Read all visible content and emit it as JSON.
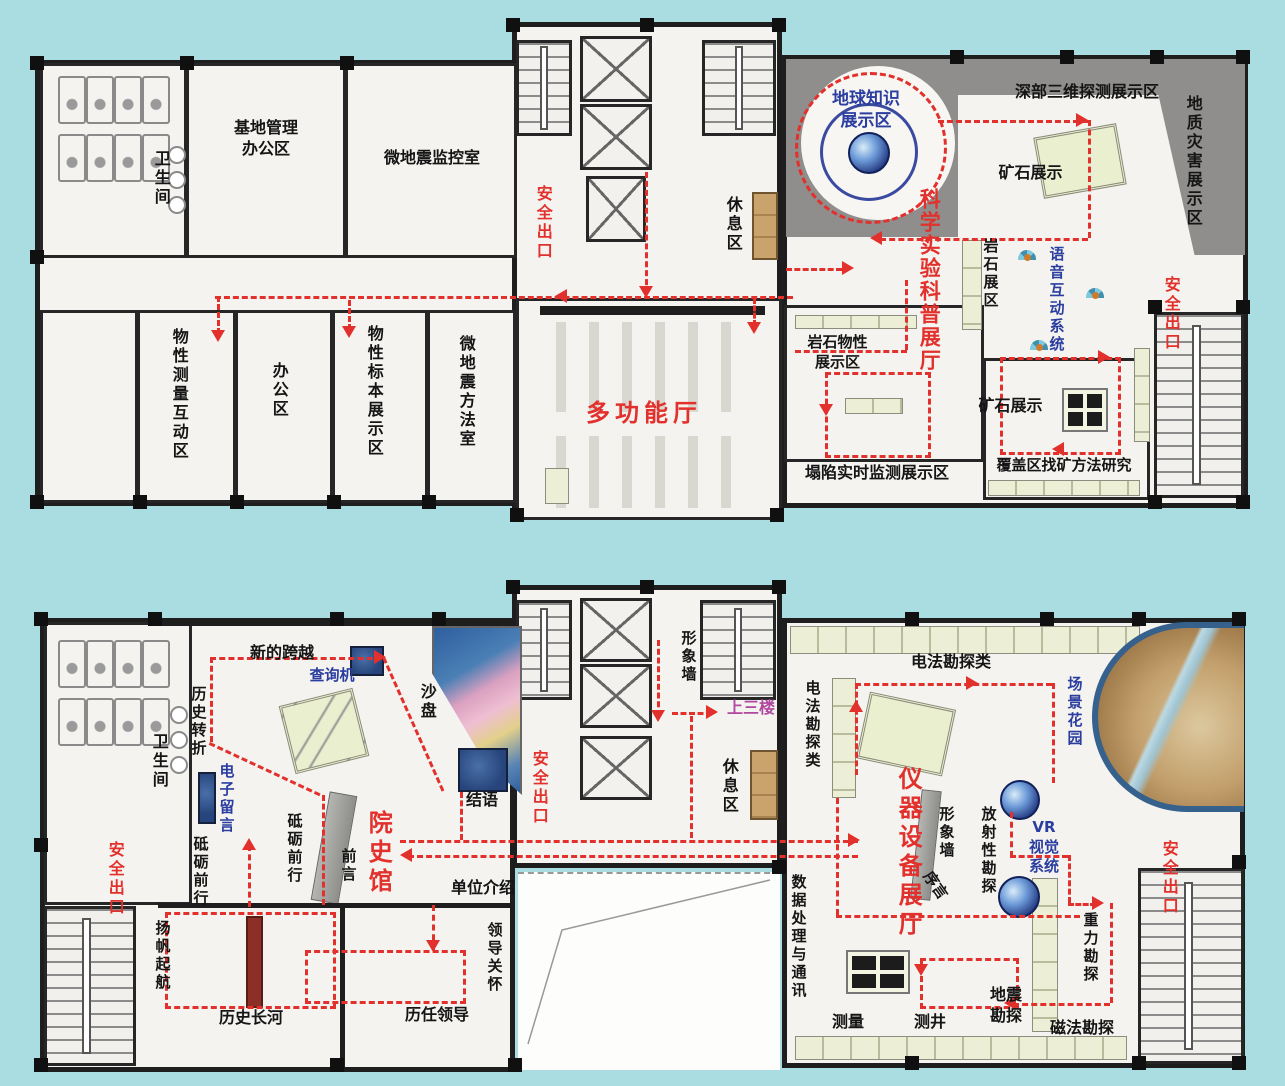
{
  "common": {
    "safety_exit": "安全出口",
    "restroom": "卫生间",
    "rest_area": "休息区",
    "ore_display": "矿石展示"
  },
  "plan_top": {
    "labels": {
      "base_office": "基地管理\n办公区",
      "micro_monitor": "微地震监控室",
      "prop_measure": "物性测量互动区",
      "office": "办公区",
      "prop_specimen": "物性标本展示区",
      "micro_method": "微地震方法室",
      "multi_hall": "多功能厅",
      "sci_hall": "科学实验科普展厅",
      "earth_knowledge": "地球知识\n展示区",
      "deep_3d": "深部三维探测展示区",
      "geo_disaster": "地质灾害展示区",
      "rock_zone": "岩石展区",
      "voice_system": "语音互动系统",
      "rock_physical": "岩石物性\n展示区",
      "collapse_monitor": "塌陷实时监测展示区",
      "covered_method": "覆盖区找矿方法研究"
    }
  },
  "plan_bottom": {
    "labels": {
      "history_hall": "院史馆",
      "new_leap": "新的跨越",
      "query_machine": "查询机",
      "sand_table": "沙盘",
      "history_turn": "历史转折",
      "e_message": "电子留言",
      "forge_ahead": "砥砺前行",
      "conclusion": "结语",
      "foreword": "前言",
      "preface": "序言",
      "sail": "扬帆起航",
      "history_river": "历史长河",
      "past_leaders": "历任领导",
      "unit_intro": "单位介绍",
      "leader_care": "领导关怀",
      "image_wall": "形象墙",
      "up_third": "上三楼",
      "instrument_hall": "仪器设备展厅",
      "electrical": "电法勘探类",
      "scene_garden": "场景花园",
      "vr_system": "VR\n视觉\n系统",
      "radioactive": "放射性勘探",
      "data_comm": "数据处理与通讯",
      "survey": "测量",
      "well_logging": "测井",
      "seismic": "地震\n勘探",
      "magnetic": "磁法勘探",
      "gravity": "重力勘探"
    }
  },
  "palette": {
    "background": "#a9dde1",
    "wall": "#1e1e1e",
    "floor": "#f4f3ef",
    "gray_zone": "#8f8e8c",
    "route_red": "#e2312d",
    "label_blue": "#2b3ea0",
    "purple": "#b0489f",
    "shelf_green": "#ecefd6",
    "sofa_tan": "#c9a36b",
    "screen_blue": "#27457c"
  }
}
